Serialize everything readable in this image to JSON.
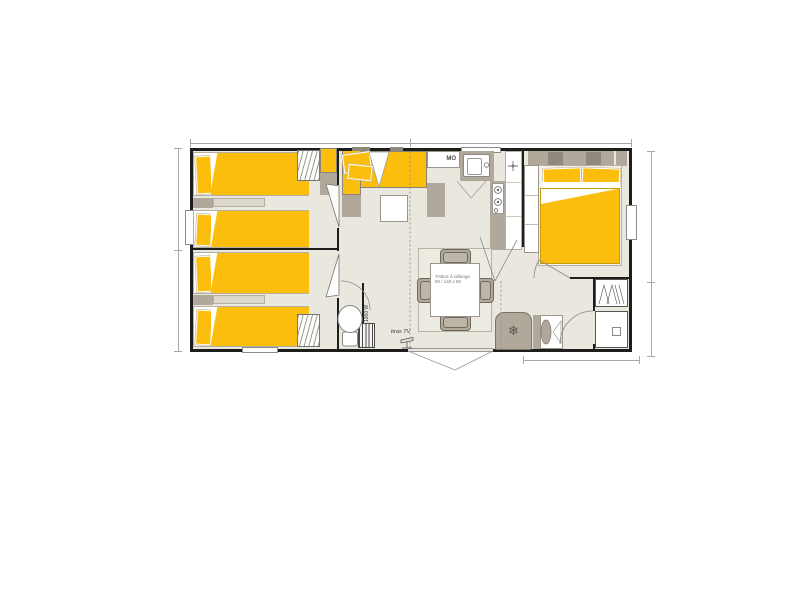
{
  "plan": {
    "type": "mobile-home-floor-plan",
    "labels": {
      "microwave": "MO",
      "tv_bracket": "bras TV",
      "heater_power": "1000 W",
      "dining_table_line1": "TABLE à rallonge",
      "dining_table_line2": "80 / 140 x 80"
    },
    "icons": {
      "fridge": "❄"
    },
    "colors": {
      "bed_yellow": "#FCBE0D",
      "furniture_gray": "#B0A89B",
      "furniture_gray_dark": "#8F887C",
      "floor": "#E9E7DE",
      "wall": "#1D1D1B",
      "dim": "#A8A8A8"
    },
    "rooms": [
      {
        "name": "bedroom-twin-left-top",
        "furniture": [
          "single bed",
          "single bed",
          "nightstand",
          "wardrobe"
        ]
      },
      {
        "name": "bedroom-twin-left-bottom",
        "furniture": [
          "single bed",
          "single bed",
          "nightstand",
          "wardrobe"
        ]
      },
      {
        "name": "living-room",
        "furniture": [
          "corner sofa",
          "coffee table",
          "extending dining table",
          "4 chairs",
          "TV bracket",
          "fridge"
        ]
      },
      {
        "name": "kitchen",
        "furniture": [
          "microwave",
          "sink",
          "hob",
          "tall counter"
        ]
      },
      {
        "name": "master-bedroom",
        "furniture": [
          "double bed",
          "headboard",
          "wardrobe"
        ]
      },
      {
        "name": "wc",
        "furniture": [
          "toilet",
          "water heater"
        ]
      },
      {
        "name": "bathroom",
        "furniture": [
          "washbasin",
          "shower",
          "hanging wardrobe"
        ]
      }
    ]
  }
}
